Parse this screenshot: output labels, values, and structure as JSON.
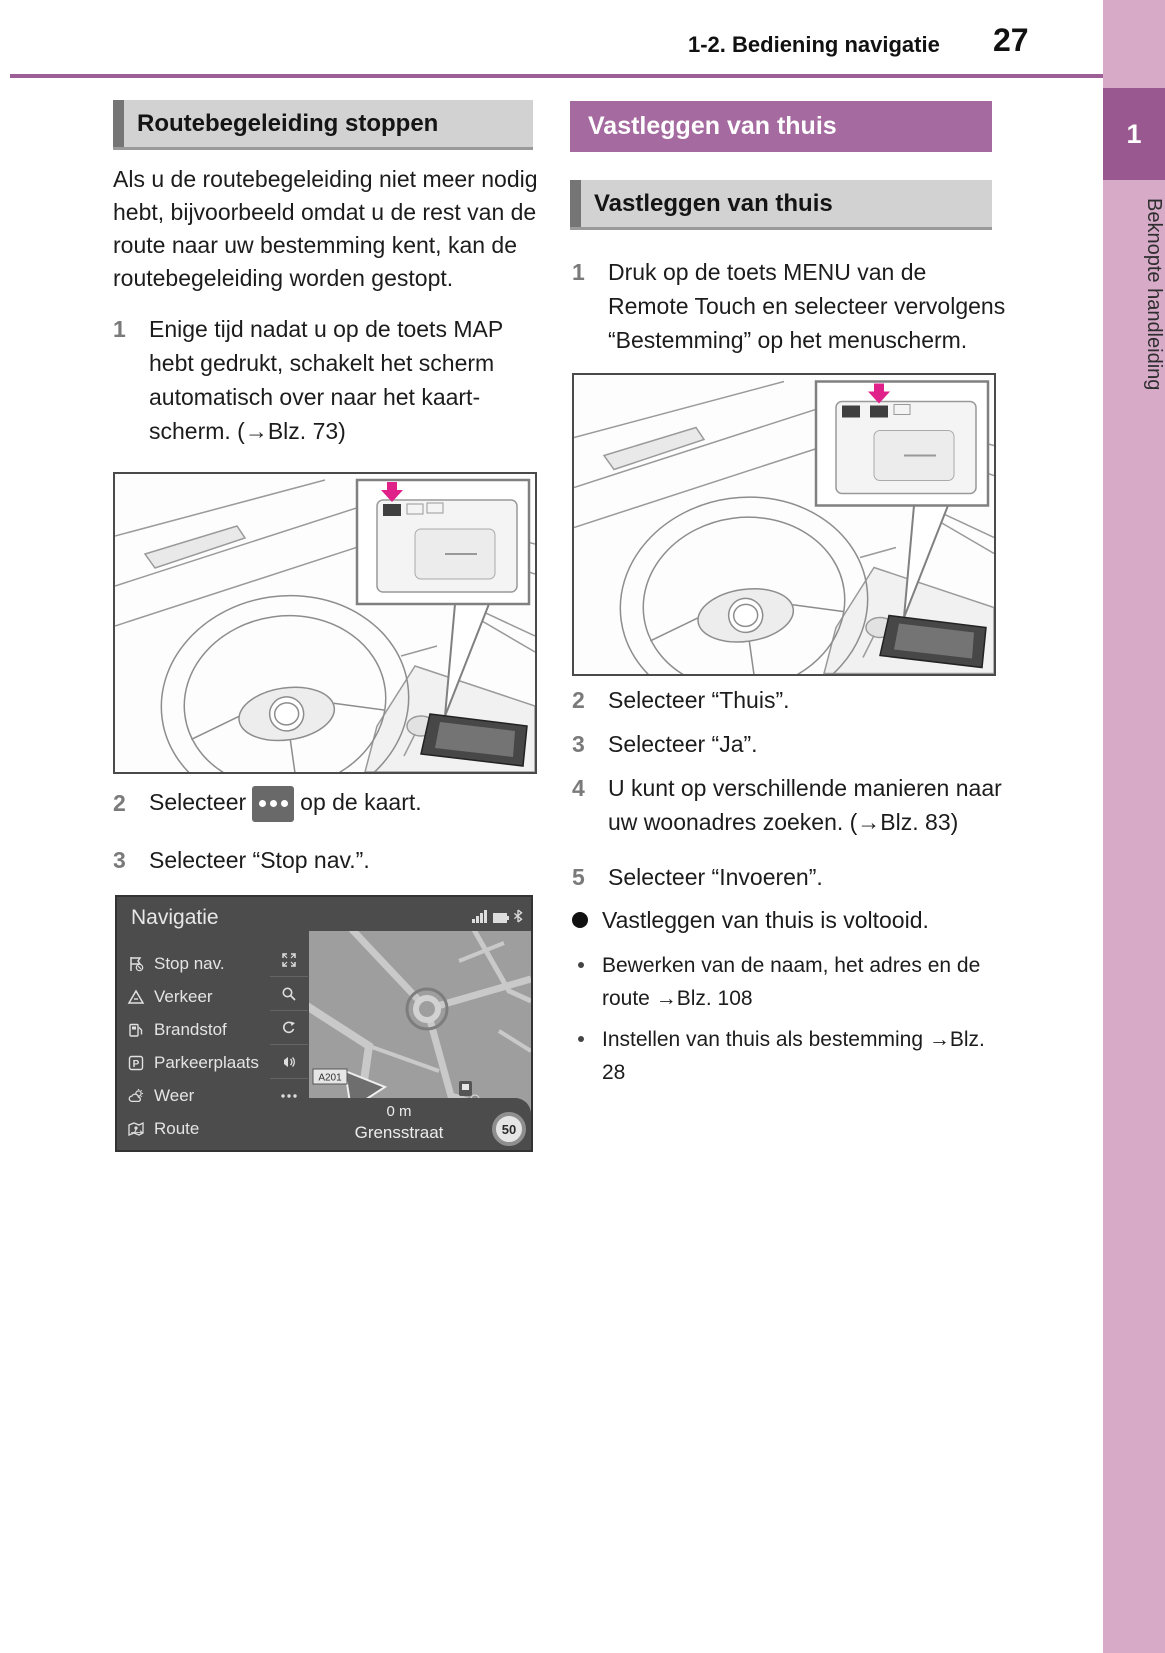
{
  "colors": {
    "rule_purple": "#9d5f96",
    "header_purple": "#a56a9f",
    "sidebar_pink": "#d7aac8",
    "chapter_purple": "#99588f",
    "section_gray": "#d2d2d2",
    "highlight_magenta": "#e0218a"
  },
  "header": {
    "section": "1-2. Bediening navigatie",
    "page_number": "27"
  },
  "sidebar": {
    "chapter_number": "1",
    "chapter_title": "Beknopte handleiding"
  },
  "left": {
    "title": "Routebegeleiding stoppen",
    "intro": "Als u de routebegeleiding niet meer nodig hebt, bijvoorbeeld omdat u de rest van de route naar uw bestemming kent, kan de routebegeleiding worden gestopt.",
    "step1": {
      "num": "1",
      "text": "Enige tijd nadat u op de toets MAP hebt gedrukt, schakelt het scherm automatisch over naar het kaart-scherm. (→Blz. 73)"
    },
    "step2": {
      "num": "2",
      "before": "Selecteer",
      "icon": "map-options-button",
      "after": "op de kaart."
    },
    "step3": {
      "num": "3",
      "text": "Selecteer “Stop nav.”."
    }
  },
  "nav_screen": {
    "title": "Navigatie",
    "status_icons": [
      "signal-icon",
      "battery-icon",
      "bluetooth-icon"
    ],
    "menu": [
      {
        "icon": "stop-nav-icon",
        "label": "Stop nav."
      },
      {
        "icon": "traffic-icon",
        "label": "Verkeer"
      },
      {
        "icon": "fuel-icon",
        "label": "Brandstof"
      },
      {
        "icon": "parking-icon",
        "label": "Parkeerplaats"
      },
      {
        "icon": "weather-icon",
        "label": "Weer"
      },
      {
        "icon": "route-icon",
        "label": "Route"
      }
    ],
    "toolbar_icons": [
      "expand-icon",
      "search-icon",
      "rotate-icon",
      "voice-icon",
      "more-icon",
      "arrow-right-icon"
    ],
    "map": {
      "road_label": "A201",
      "distance": "0 m",
      "street": "Grensstraat",
      "speed_limit": "50"
    }
  },
  "right": {
    "title": "Vastleggen van thuis",
    "subtitle": "Vastleggen van thuis",
    "step1": {
      "num": "1",
      "text": "Druk op de toets MENU van de Remote Touch en selecteer vervolgens “Bestemming” op het menuscherm."
    },
    "step2": {
      "num": "2",
      "text": "Selecteer “Thuis”."
    },
    "step3": {
      "num": "3",
      "text": "Selecteer “Ja”."
    },
    "step4": {
      "num": "4",
      "text": "U kunt op verschillende manieren naar uw woonadres zoeken. (→Blz. 83)"
    },
    "step5": {
      "num": "5",
      "text": "Selecteer “Invoeren”."
    },
    "done": "Vastleggen van thuis is voltooid.",
    "notes": [
      "Bewerken van de naam, het adres en de route →Blz. 108",
      "Instellen van thuis als bestemming →Blz. 28"
    ]
  }
}
